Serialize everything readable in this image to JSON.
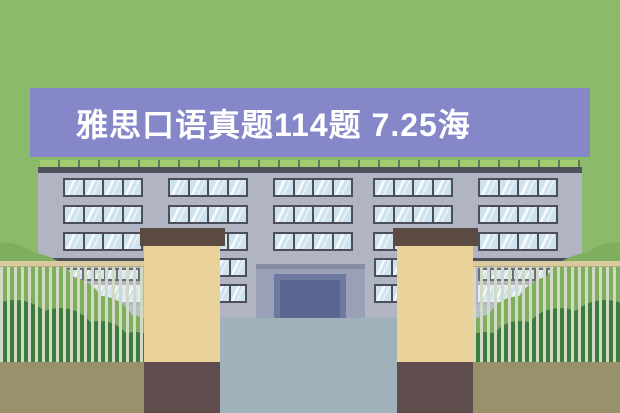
{
  "banner": {
    "title": "雅思口语真题114题 7.25海",
    "bg_color": "#8587c8",
    "text_color": "#ffffff"
  },
  "background_color": "#8cba6b",
  "scene": {
    "description": "flat illustration of a school building with gate pillars, fence and bushes",
    "colors": {
      "bg": "#8cba6b",
      "banner": "#8587c8",
      "titlecolor": "#ffffff",
      "facade": "#b0b4c3",
      "roofline": "#50525b",
      "railseg": "#a3cb70",
      "railpost": "#68775a",
      "frame": "#4c4f58",
      "pane": "#cfe3ee",
      "portico": "#9aa0b5",
      "porticobar": "#868ca3",
      "doorframe": "#6e79a0",
      "doorpanel": "#5a6590",
      "path": "#9fb2bc",
      "understrip": "#b6c1c9",
      "ground": "#99916b",
      "cap": "#5b4a42",
      "pillar": "#ead29b",
      "base": "#5f4c4d",
      "fencerail": "#d9caa0",
      "fencerailedge": "#b8ab82",
      "fencepost": "#d2dac6",
      "ledge": "#4c4f58",
      "bushlight": "#7fae5e",
      "bushdark": "#3e7b3e",
      "wingframeA": "#6a6d77",
      "wingframeB": "#e8edf1"
    },
    "windows": {
      "rows": [
        178,
        205,
        232
      ],
      "groups_x": [
        63,
        168,
        273,
        373,
        478
      ],
      "group_w": 80,
      "group_h": 19,
      "panes": 4
    },
    "small_windows": {
      "xs": [
        212,
        374
      ],
      "ys": [
        258,
        284
      ],
      "w": 35,
      "h": 19,
      "panes": 2
    },
    "wing_windows": {
      "wings_x": [
        48,
        478
      ],
      "w": 92,
      "rows": [
        {
          "y": 268,
          "h": 13,
          "panes": 8,
          "frame": "A"
        },
        {
          "y": 285,
          "h": 17,
          "panes": 6,
          "frame": "B"
        }
      ]
    },
    "bushes": {
      "left": [
        [
          0,
          300,
          58,
          "light"
        ],
        [
          30,
          305,
          52,
          "light"
        ],
        [
          65,
          318,
          42,
          "light"
        ],
        [
          100,
          332,
          36,
          "light"
        ],
        [
          130,
          345,
          30,
          "light"
        ],
        [
          15,
          345,
          45,
          "dark"
        ],
        [
          60,
          348,
          40,
          "dark"
        ],
        [
          100,
          355,
          34,
          "dark"
        ],
        [
          135,
          362,
          30,
          "dark"
        ],
        [
          160,
          370,
          26,
          "dark"
        ]
      ],
      "right": [
        [
          620,
          300,
          58,
          "light"
        ],
        [
          590,
          305,
          52,
          "light"
        ],
        [
          555,
          318,
          42,
          "light"
        ],
        [
          520,
          332,
          36,
          "light"
        ],
        [
          490,
          345,
          30,
          "light"
        ],
        [
          605,
          345,
          45,
          "dark"
        ],
        [
          560,
          348,
          40,
          "dark"
        ],
        [
          520,
          355,
          34,
          "dark"
        ],
        [
          485,
          362,
          30,
          "dark"
        ],
        [
          462,
          370,
          26,
          "dark"
        ]
      ]
    }
  }
}
